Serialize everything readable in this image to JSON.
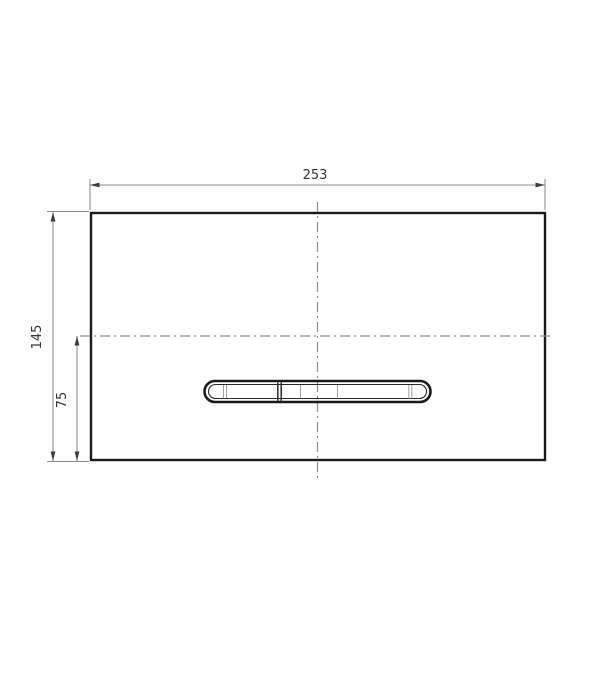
{
  "drawing": {
    "labels": {
      "width": "253",
      "height": "145",
      "offset": "75"
    },
    "colors": {
      "outline": "#1a1a1a",
      "dimension": "#8a8a8a",
      "arrow": "#3d3d3d",
      "centerline": "#8f8f8f",
      "divider": "#a0a0a0",
      "text": "#333333",
      "background": "#ffffff"
    }
  }
}
